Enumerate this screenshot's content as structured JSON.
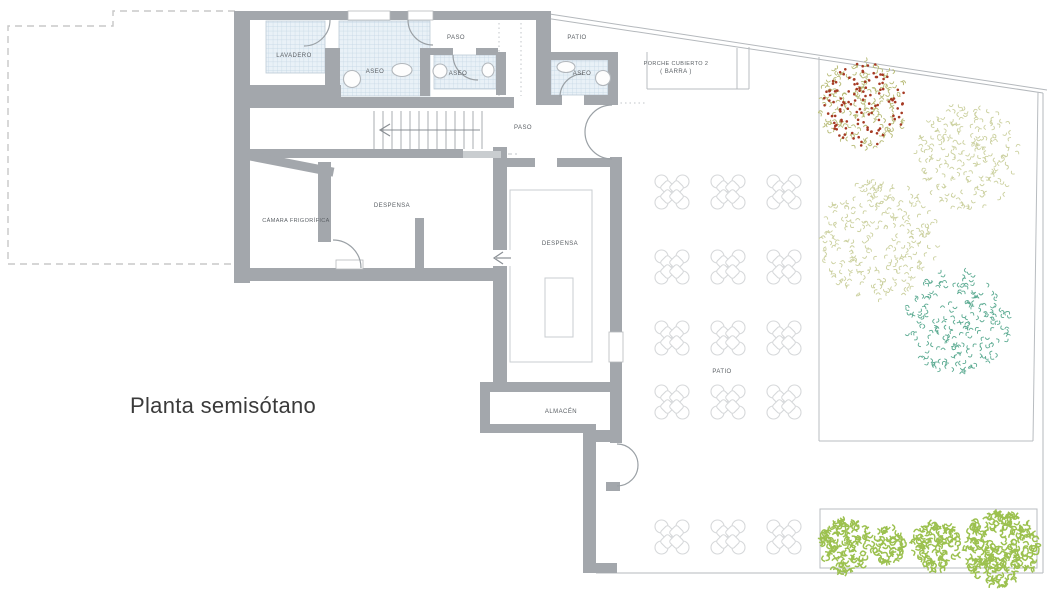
{
  "title": "Planta semisótano",
  "plan": {
    "colors": {
      "wall": "#a3a7ac",
      "wall_light": "#c9cdd0",
      "tile_fill": "#e9f1f7",
      "tile_line": "#c3d6e3",
      "thin_line": "#b4b8bc",
      "dashed_outline": "#c8c8c8",
      "door_arc": "#9aa0a5",
      "stair_tread": "#a8acb0",
      "chair": "#d6d8da",
      "label_text": "#5a5f64",
      "title_text": "#3a3a3a",
      "tree_olive": "#ccd1a0",
      "tree_dark_olive": "#b6ba74",
      "tree_red_berries": "#a63a24",
      "tree_teal": "#5cab92",
      "bush_green": "#9cc14f"
    },
    "labels": [
      {
        "text": "LAVADERO",
        "x": 294,
        "y": 57
      },
      {
        "text": "ASEO",
        "x": 375,
        "y": 73
      },
      {
        "text": "PASO",
        "x": 456,
        "y": 39
      },
      {
        "text": "ASEO",
        "x": 458,
        "y": 75
      },
      {
        "text": "PATIO",
        "x": 577,
        "y": 39
      },
      {
        "text": "ASEO",
        "x": 582,
        "y": 75
      },
      {
        "text": "PORCHE CUBIERTO 2",
        "x": 676,
        "y": 65
      },
      {
        "text": "( BARRA )",
        "x": 676,
        "y": 73
      },
      {
        "text": "PASO",
        "x": 523,
        "y": 129
      },
      {
        "text": "DESPENSA",
        "x": 392,
        "y": 207
      },
      {
        "text": "CÁMARA FRIGORÍFICA",
        "x": 296,
        "y": 222
      },
      {
        "text": "DESPENSA",
        "x": 560,
        "y": 245
      },
      {
        "text": "ALMACÉN",
        "x": 561,
        "y": 413
      },
      {
        "text": "PATIO",
        "x": 722,
        "y": 373
      }
    ],
    "stairs": {
      "x1": 374,
      "x2": 482,
      "y1": 111,
      "y2": 149,
      "step": 9,
      "arrow_y": 130
    },
    "tables": {
      "cols": [
        672,
        728,
        784
      ],
      "rows": [
        192,
        267,
        338,
        402,
        537
      ]
    },
    "trees": [
      {
        "name": "flowering-tree",
        "cx": 864,
        "cy": 104,
        "r": 46,
        "color": "#b6ba74",
        "seed": 11,
        "density": 0.085,
        "accent": {
          "color": "#a63a24",
          "count": 120,
          "seed": 99
        }
      },
      {
        "name": "olive-tree-1",
        "cx": 967,
        "cy": 157,
        "r": 54,
        "color": "#ccd1a0",
        "seed": 22,
        "density": 0.07
      },
      {
        "name": "olive-tree-2",
        "cx": 879,
        "cy": 240,
        "r": 60,
        "color": "#ccd1a0",
        "seed": 33,
        "density": 0.07
      },
      {
        "name": "teal-tree",
        "cx": 958,
        "cy": 321,
        "r": 53,
        "color": "#5cab92",
        "seed": 44,
        "density": 0.075
      }
    ],
    "bushes": {
      "color": "#9cc14f",
      "seed": 7,
      "density": 0.2,
      "scale": 1.35,
      "items": [
        [
          846,
          546,
          27
        ],
        [
          889,
          545,
          18
        ],
        [
          936,
          546,
          25
        ],
        [
          1001,
          549,
          38
        ]
      ]
    }
  }
}
